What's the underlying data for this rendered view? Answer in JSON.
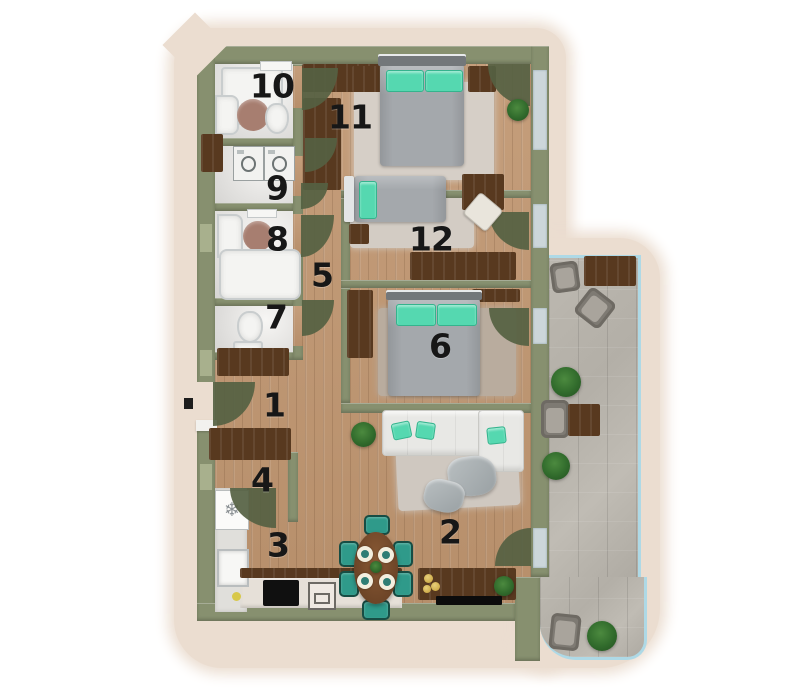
{
  "title": "apartment-floor-plan",
  "rooms": [
    {
      "id": "room-1",
      "label": "1"
    },
    {
      "id": "room-2",
      "label": "2"
    },
    {
      "id": "room-3",
      "label": "3"
    },
    {
      "id": "room-4",
      "label": "4"
    },
    {
      "id": "room-5",
      "label": "5"
    },
    {
      "id": "room-6",
      "label": "6"
    },
    {
      "id": "room-7",
      "label": "7"
    },
    {
      "id": "room-8",
      "label": "8"
    },
    {
      "id": "room-9",
      "label": "9"
    },
    {
      "id": "room-10",
      "label": "10"
    },
    {
      "id": "room-11",
      "label": "11"
    },
    {
      "id": "room-12",
      "label": "12"
    }
  ],
  "colors": {
    "background": "#ffffff",
    "site_halo": "#ebddd0",
    "wall_sage": "#87906f",
    "door_swing_olive": "#556142",
    "wood_floor": "#c19a77",
    "dark_walnut": "#58391f",
    "bath_floor": "#ecebe9",
    "terrace_tile": "#b6b2aa",
    "glass_railing": "#aed9e6",
    "accent_teal": "#55d8b0",
    "dining_chair_teal": "#2f9a8a",
    "bed_gray": "#a4a8ac",
    "sofa_white": "#e8e8e5",
    "rug_gray": "#d6cfc7"
  }
}
